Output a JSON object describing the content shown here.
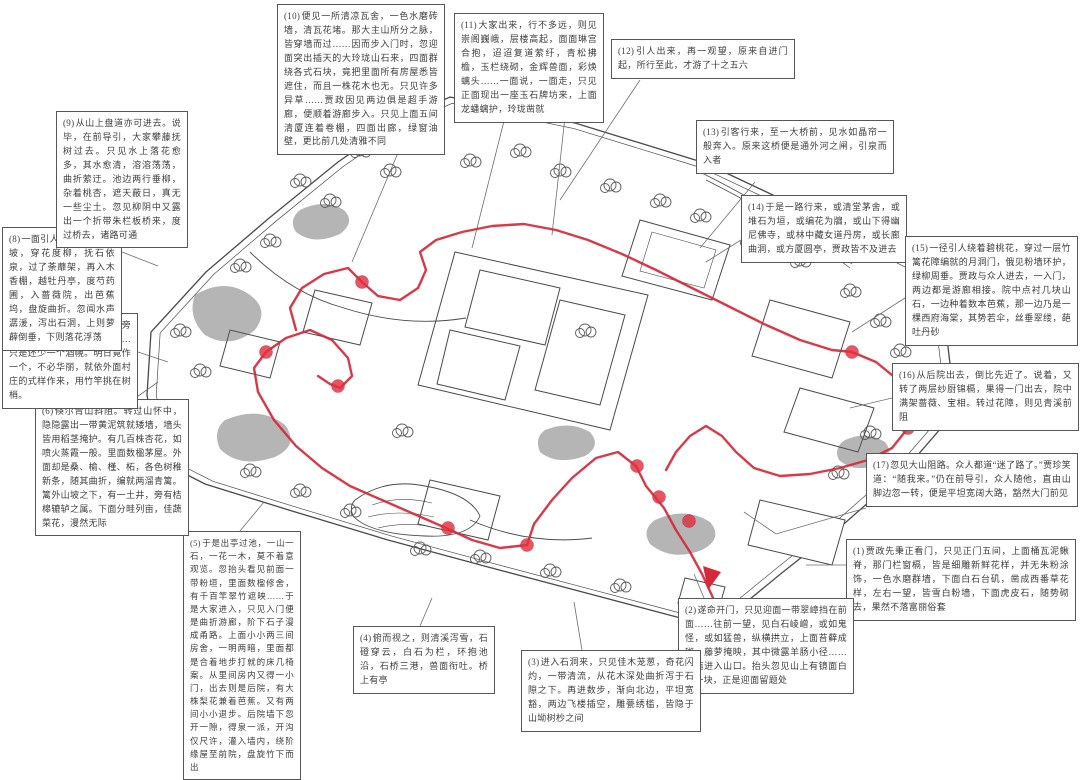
{
  "colors": {
    "route_red": "#d5293b",
    "node_red": "#e23040",
    "ink": "#4a4a4a"
  },
  "annotations": [
    {
      "label": "(1)",
      "text": "贾政先秉正看门，只见正门五间，上面桶瓦泥鳅脊，那门栏窗槅，皆是细雕新鲜花样，并无朱粉涂饰，一色水磨群墙，下面白石台矶，凿成西番草花样，左右一望，皆雪白粉墙，下面虎皮石，随势砌去，果然不落富丽俗套"
    },
    {
      "label": "(2)",
      "text": "遂命开门，只见迎面一带翠嶂挡在前面……往前一望，见白石崚嶒，或如鬼怪，或如猛兽，纵横拱立，上面苔藓成斑，藤萝掩映，其中微露羊肠小径……逶迤进入山口。抬头忽见山上有镜面白石一块，正是迎面留题处"
    },
    {
      "label": "(3)",
      "text": "进入石洞来，只见佳木茏葱，奇花闪灼，一带清流，从花木深处曲折泻于石隙之下。再进数步，渐向北边，平坦宽豁，两边飞楼插空，雕甍绣槛，皆隐于山坳树杪之间"
    },
    {
      "label": "(4)",
      "text": "俯而视之，则清溪泻雪，石磴穿云，白石为栏，环抱池沿，石桥三港，兽面衔吐。桥上有亭"
    },
    {
      "label": "(5)",
      "text": "于是出亭过池，一山一石，一花一木，莫不着意观览。忽抬头看见前面一带粉垣，里面数楹修舍，有千百竿翠竹遮映……于是大家进入，只见入门便是曲折游廊，阶下石子漫成甬路。上面小小两三间房舍，一明两暗，里面都是合着地步打就的床几椅案。从里间房内又得一小门，出去则是后院，有大株梨花兼着芭蕉。又有两间小小退步。后院墙下忽开一隙，得泉一派，开沟仅尺许，灌入墙内，绕阶缘屋至前院，盘旋竹下而出"
    },
    {
      "label": "(6)",
      "text": "倏尔青山斜阻。转过山怀中，隐隐露出一带黄泥筑就矮墙，墙头皆用稻茎掩护。有几百株杏花，如喷火蒸霞一般。里面数楹茅屋。外面却是桑、榆、槿、柘，各色树稚新条，随其曲折，编就两溜青篱。篱外山坡之下，有一土井，旁有桔槔辘轳之属。下面分畦列亩，佳蔬菜花，漫然无际"
    },
    {
      "label": "(7)",
      "text": "方欲进篱门去，忽见路旁有一石碣，亦为留题之备……只是还少一个酒幌。明日竟作一个，不必华丽，就依外面村庄的式样作来，用竹竿挑在树梢。"
    },
    {
      "label": "(8)",
      "text": "一面引人出来，转过山坡，穿花度柳，抚石依泉，过了荼蘼架，再入木香棚，越牡丹亭，度芍药圃，入蔷薇院，出芭蕉坞，盘旋曲折。忽闻水声潺湲，泻出石洞，上则萝薜倒垂，下则落花浮荡"
    },
    {
      "label": "(9)",
      "text": "从山上盘道亦可进去。说毕，在前导引，大家攀藤抚树过去。只见水上落花愈多，其水愈清，溶溶荡荡，曲折萦迂。池边两行垂柳，杂着桃杏，遮天蔽日，真无一些尘土。忽见柳阴中又露出一个折带朱栏板桥来，度过桥去，诸路可通"
    },
    {
      "label": "(10)",
      "text": "便见一所清凉瓦舍，一色水磨砖墙，清瓦花堵。那大主山所分之脉，皆穿墙而过……因而步入门时，忽迎面突出插天的大玲珑山石来，四面群绕各式石块，竟把里面所有房屋悉皆遮住，而且一株花木也无。只见许多异草……贾政因见两边俱是超手游廊，便顺着游廊步入。只见上面五间清厦连着卷棚，四面出廊，绿窗油壁，更比前几处清雅不同"
    },
    {
      "label": "(11)",
      "text": "大家出来，行不多远，则见崇阁巍峨，层楼高起，面面琳宫合抱，迢迢复道萦纡，青松拂檐，玉栏绕砌，金辉兽面，彩焕螭头……一面说，一面走，只见正面现出一座玉石牌坊来，上面龙蟠螭护，玲珑凿就"
    },
    {
      "label": "(12)",
      "text": "引人出来，再一观望，原来自进门起，所行至此，才游了十之五六"
    },
    {
      "label": "(13)",
      "text": "引客行来，至一大桥前，见水如晶帘一般奔入。原来这桥便是通外河之闸，引泉而入者"
    },
    {
      "label": "(14)",
      "text": "于是一路行来，或清堂茅舍，或堆石为垣，或编花为牖，或山下得幽尼佛寺，或林中藏女道丹房，或长廊曲洞，或方厦圆亭，贾政皆不及进去"
    },
    {
      "label": "(15)",
      "text": "一径引人绕着碧桃花，穿过一层竹篱花障编就的月洞门，俄见粉墙环护，绿柳周垂。贾政与众人进去，一入门，两边都是游廊相接。院中点衬几块山石，一边种着数本芭蕉，那一边乃是一棵西府海棠，其势若伞，丝垂翠缕，葩吐丹砂"
    },
    {
      "label": "(16)",
      "text": "从后院出去，倒比先近了。说着，又转了两层纱厨锦槅，果得一门出去，院中满架蔷薇、宝相。转过花障，则见青溪前阻"
    },
    {
      "label": "(17)",
      "text": "忽见大山阻路。众人都道“迷了路了。”贾珍笑道：“随我来。”仍在前导引，众人随他，直由山脚边忽一转，便是平坦宽阔大路，豁然大门前见"
    }
  ]
}
